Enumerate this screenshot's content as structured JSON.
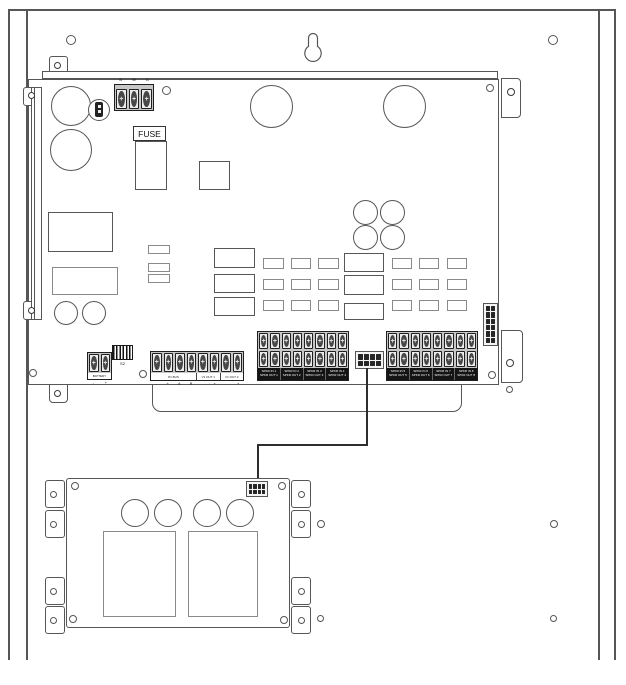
{
  "main_board": {
    "ac_terminal_labels": [
      "B",
      "W",
      "G"
    ],
    "fuse_label": "FUSE",
    "battery": {
      "label": "BATTERY",
      "marks": [
        "-",
        "+"
      ]
    },
    "dip_switch_label": "S2",
    "io_block": {
      "group_labels": [
        "P1 BUS",
        "V1 OUT 1",
        "V1 OUT 2"
      ],
      "terminal_marks": [
        "-",
        "+",
        "A",
        "B",
        "-",
        "+",
        "-",
        "+"
      ]
    },
    "spkr_block_a": {
      "groups": [
        {
          "l1": "SPKR IN 1",
          "l2": "SPKR OUT 1"
        },
        {
          "l1": "SPKR IN 2",
          "l2": "SPKR OUT 2"
        },
        {
          "l1": "SPKR IN 3",
          "l2": "SPKR OUT 3"
        },
        {
          "l1": "SPKR IN 4",
          "l2": "SPKR OUT 4"
        }
      ]
    },
    "spkr_block_b": {
      "groups": [
        {
          "l1": "SPKR IN 5",
          "l2": "SPKR OUT 5"
        },
        {
          "l1": "SPKR IN 6",
          "l2": "SPKR OUT 6"
        },
        {
          "l1": "SPKR IN 7",
          "l2": "SPKR OUT 7"
        },
        {
          "l1": "SPKR IN 8",
          "l2": "SPKR OUT 8"
        }
      ]
    }
  },
  "colors": {
    "line": "#565656",
    "dark": "#1f1f1f",
    "wire": "#2e2e2e"
  }
}
